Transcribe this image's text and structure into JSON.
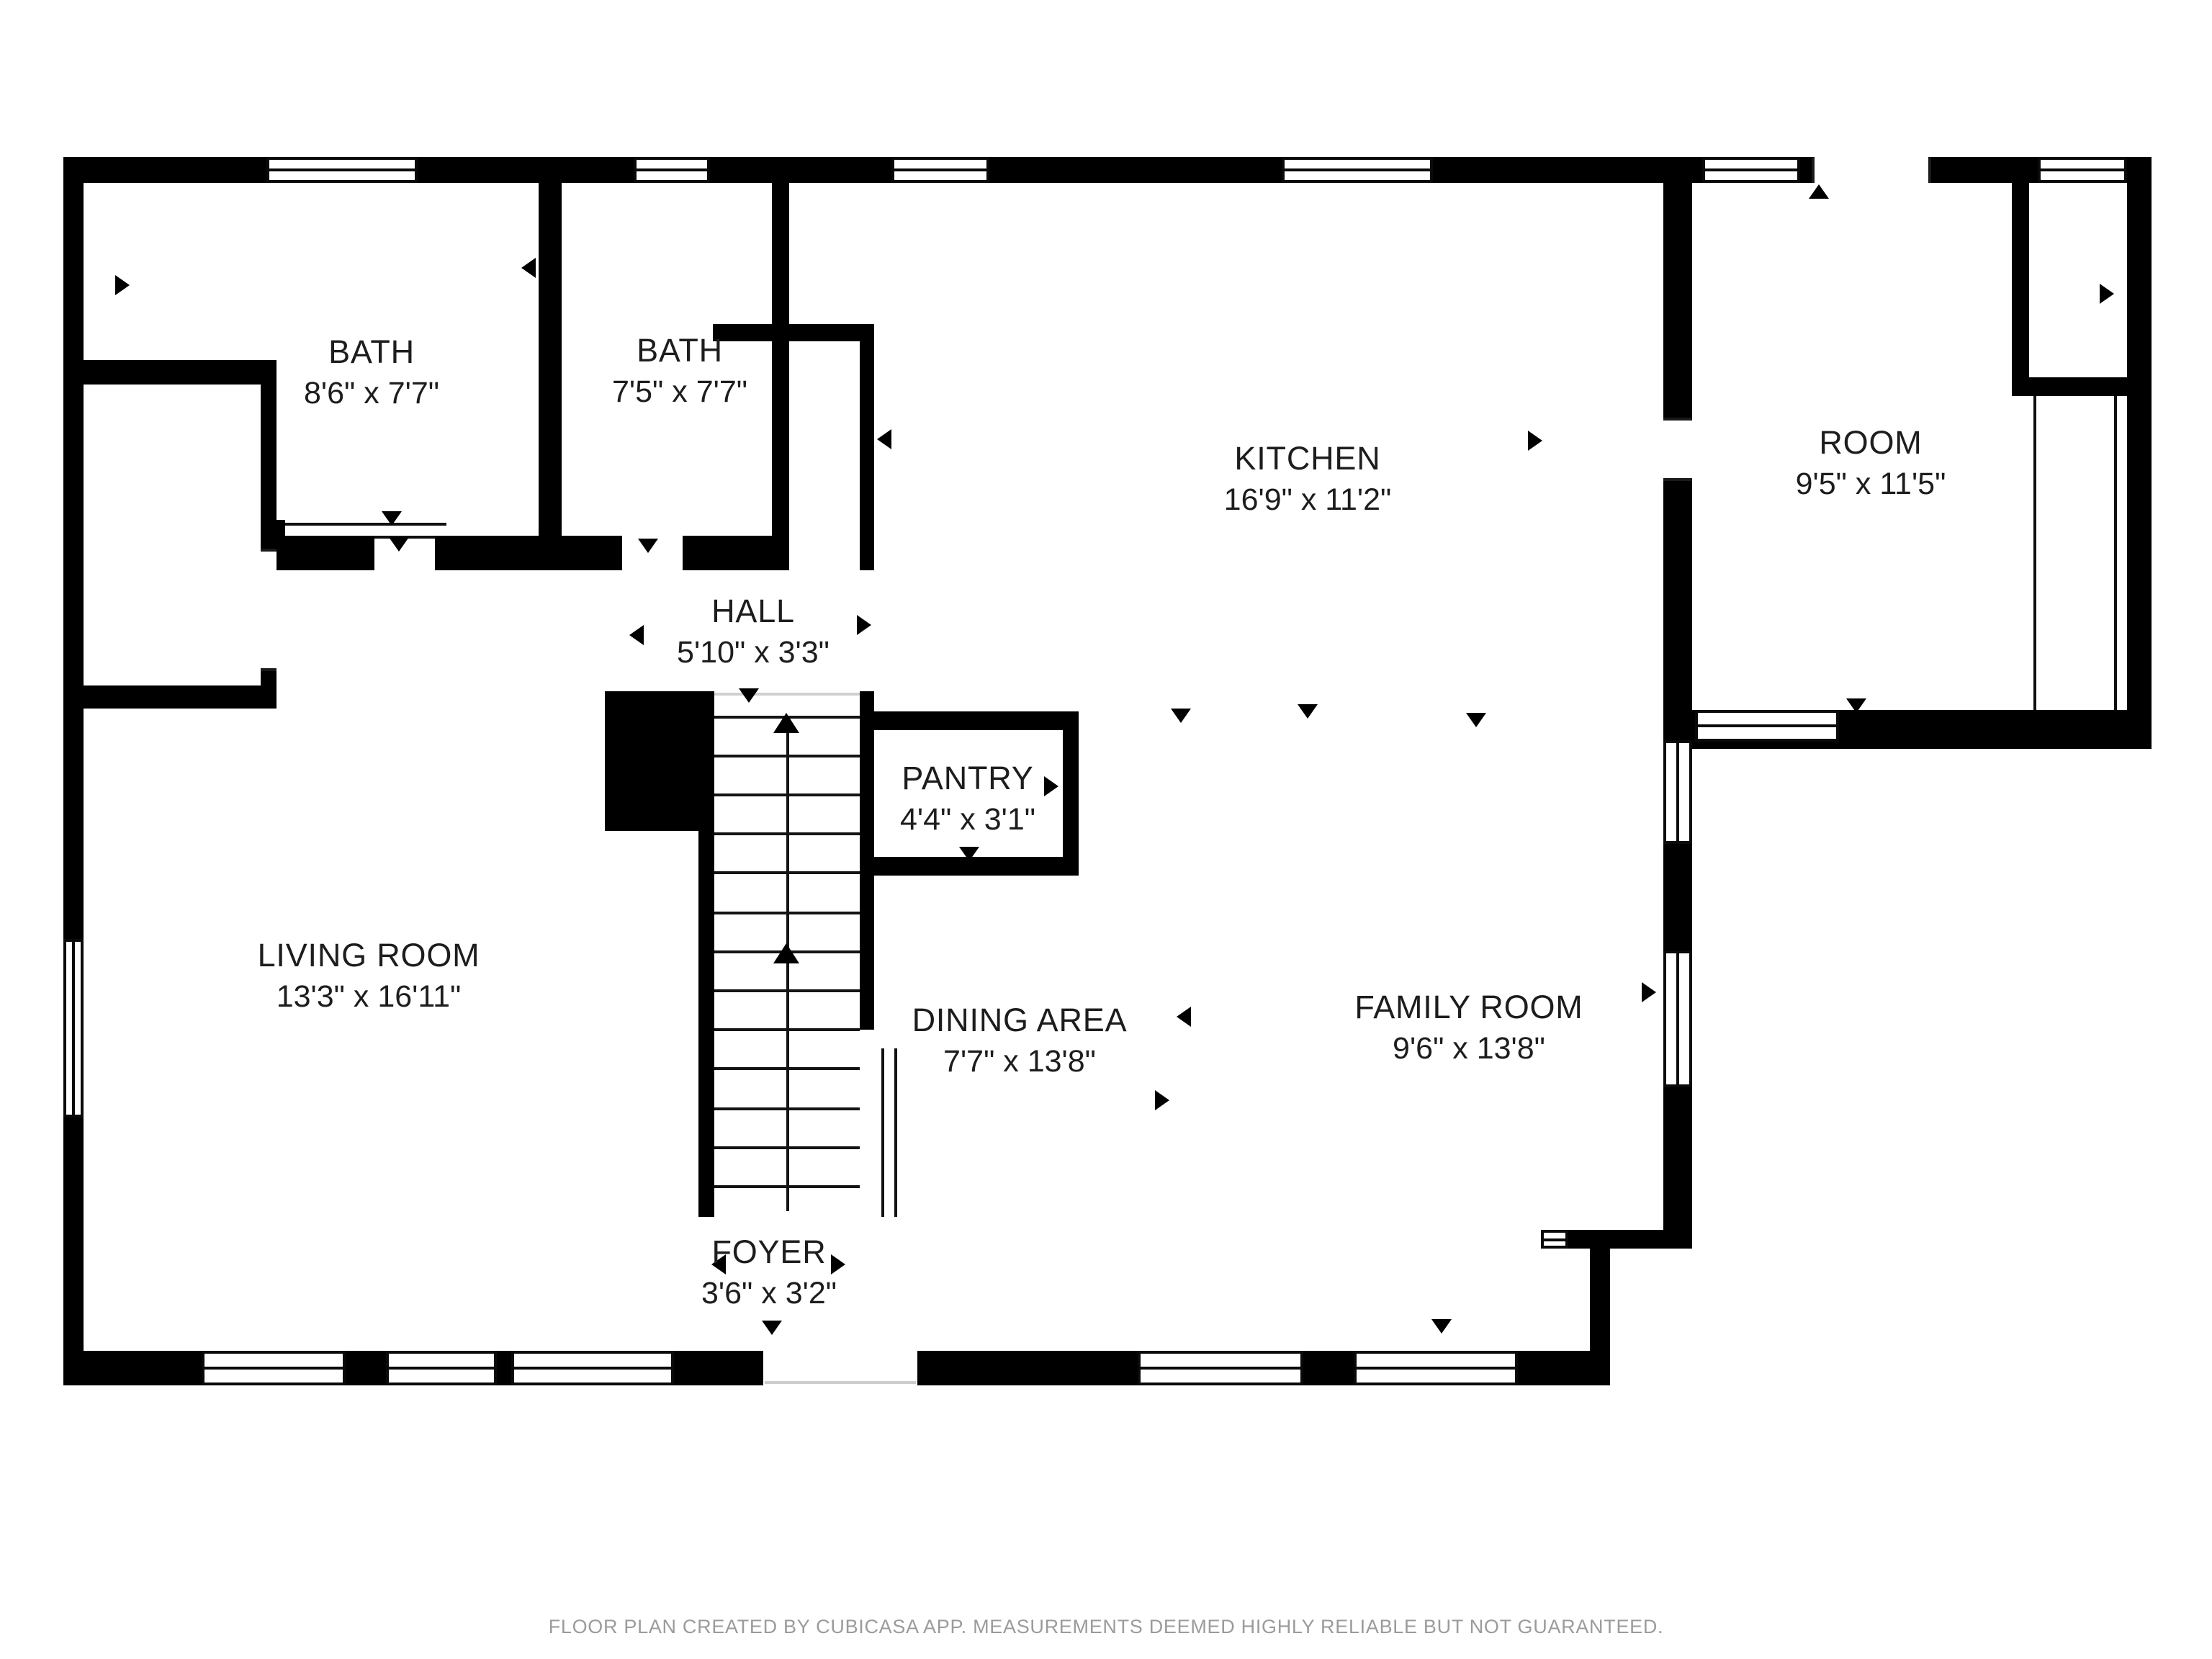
{
  "colors": {
    "wall": "#000000",
    "background": "#ffffff",
    "label_text": "#1d1d1d",
    "footer_text": "#9b9b9b"
  },
  "rooms": [
    {
      "id": "bath-1",
      "name": "BATH",
      "dims": "8'6\" x 7'7\""
    },
    {
      "id": "bath-2",
      "name": "BATH",
      "dims": "7'5\" x 7'7\""
    },
    {
      "id": "kitchen",
      "name": "KITCHEN",
      "dims": "16'9\" x 11'2\""
    },
    {
      "id": "room",
      "name": "ROOM",
      "dims": "9'5\" x 11'5\""
    },
    {
      "id": "hall",
      "name": "HALL",
      "dims": "5'10\" x 3'3\""
    },
    {
      "id": "pantry",
      "name": "PANTRY",
      "dims": "4'4\" x 3'1\""
    },
    {
      "id": "living-room",
      "name": "LIVING ROOM",
      "dims": "13'3\" x 16'11\""
    },
    {
      "id": "dining-area",
      "name": "DINING AREA",
      "dims": "7'7\" x 13'8\""
    },
    {
      "id": "family-room",
      "name": "FAMILY ROOM",
      "dims": "9'6\" x 13'8\""
    },
    {
      "id": "foyer",
      "name": "FOYER",
      "dims": "3'6\" x 3'2\""
    }
  ],
  "footer": {
    "text": "FLOOR PLAN CREATED BY CUBICASA APP. MEASUREMENTS DEEMED HIGHLY RELIABLE BUT NOT GUARANTEED."
  }
}
